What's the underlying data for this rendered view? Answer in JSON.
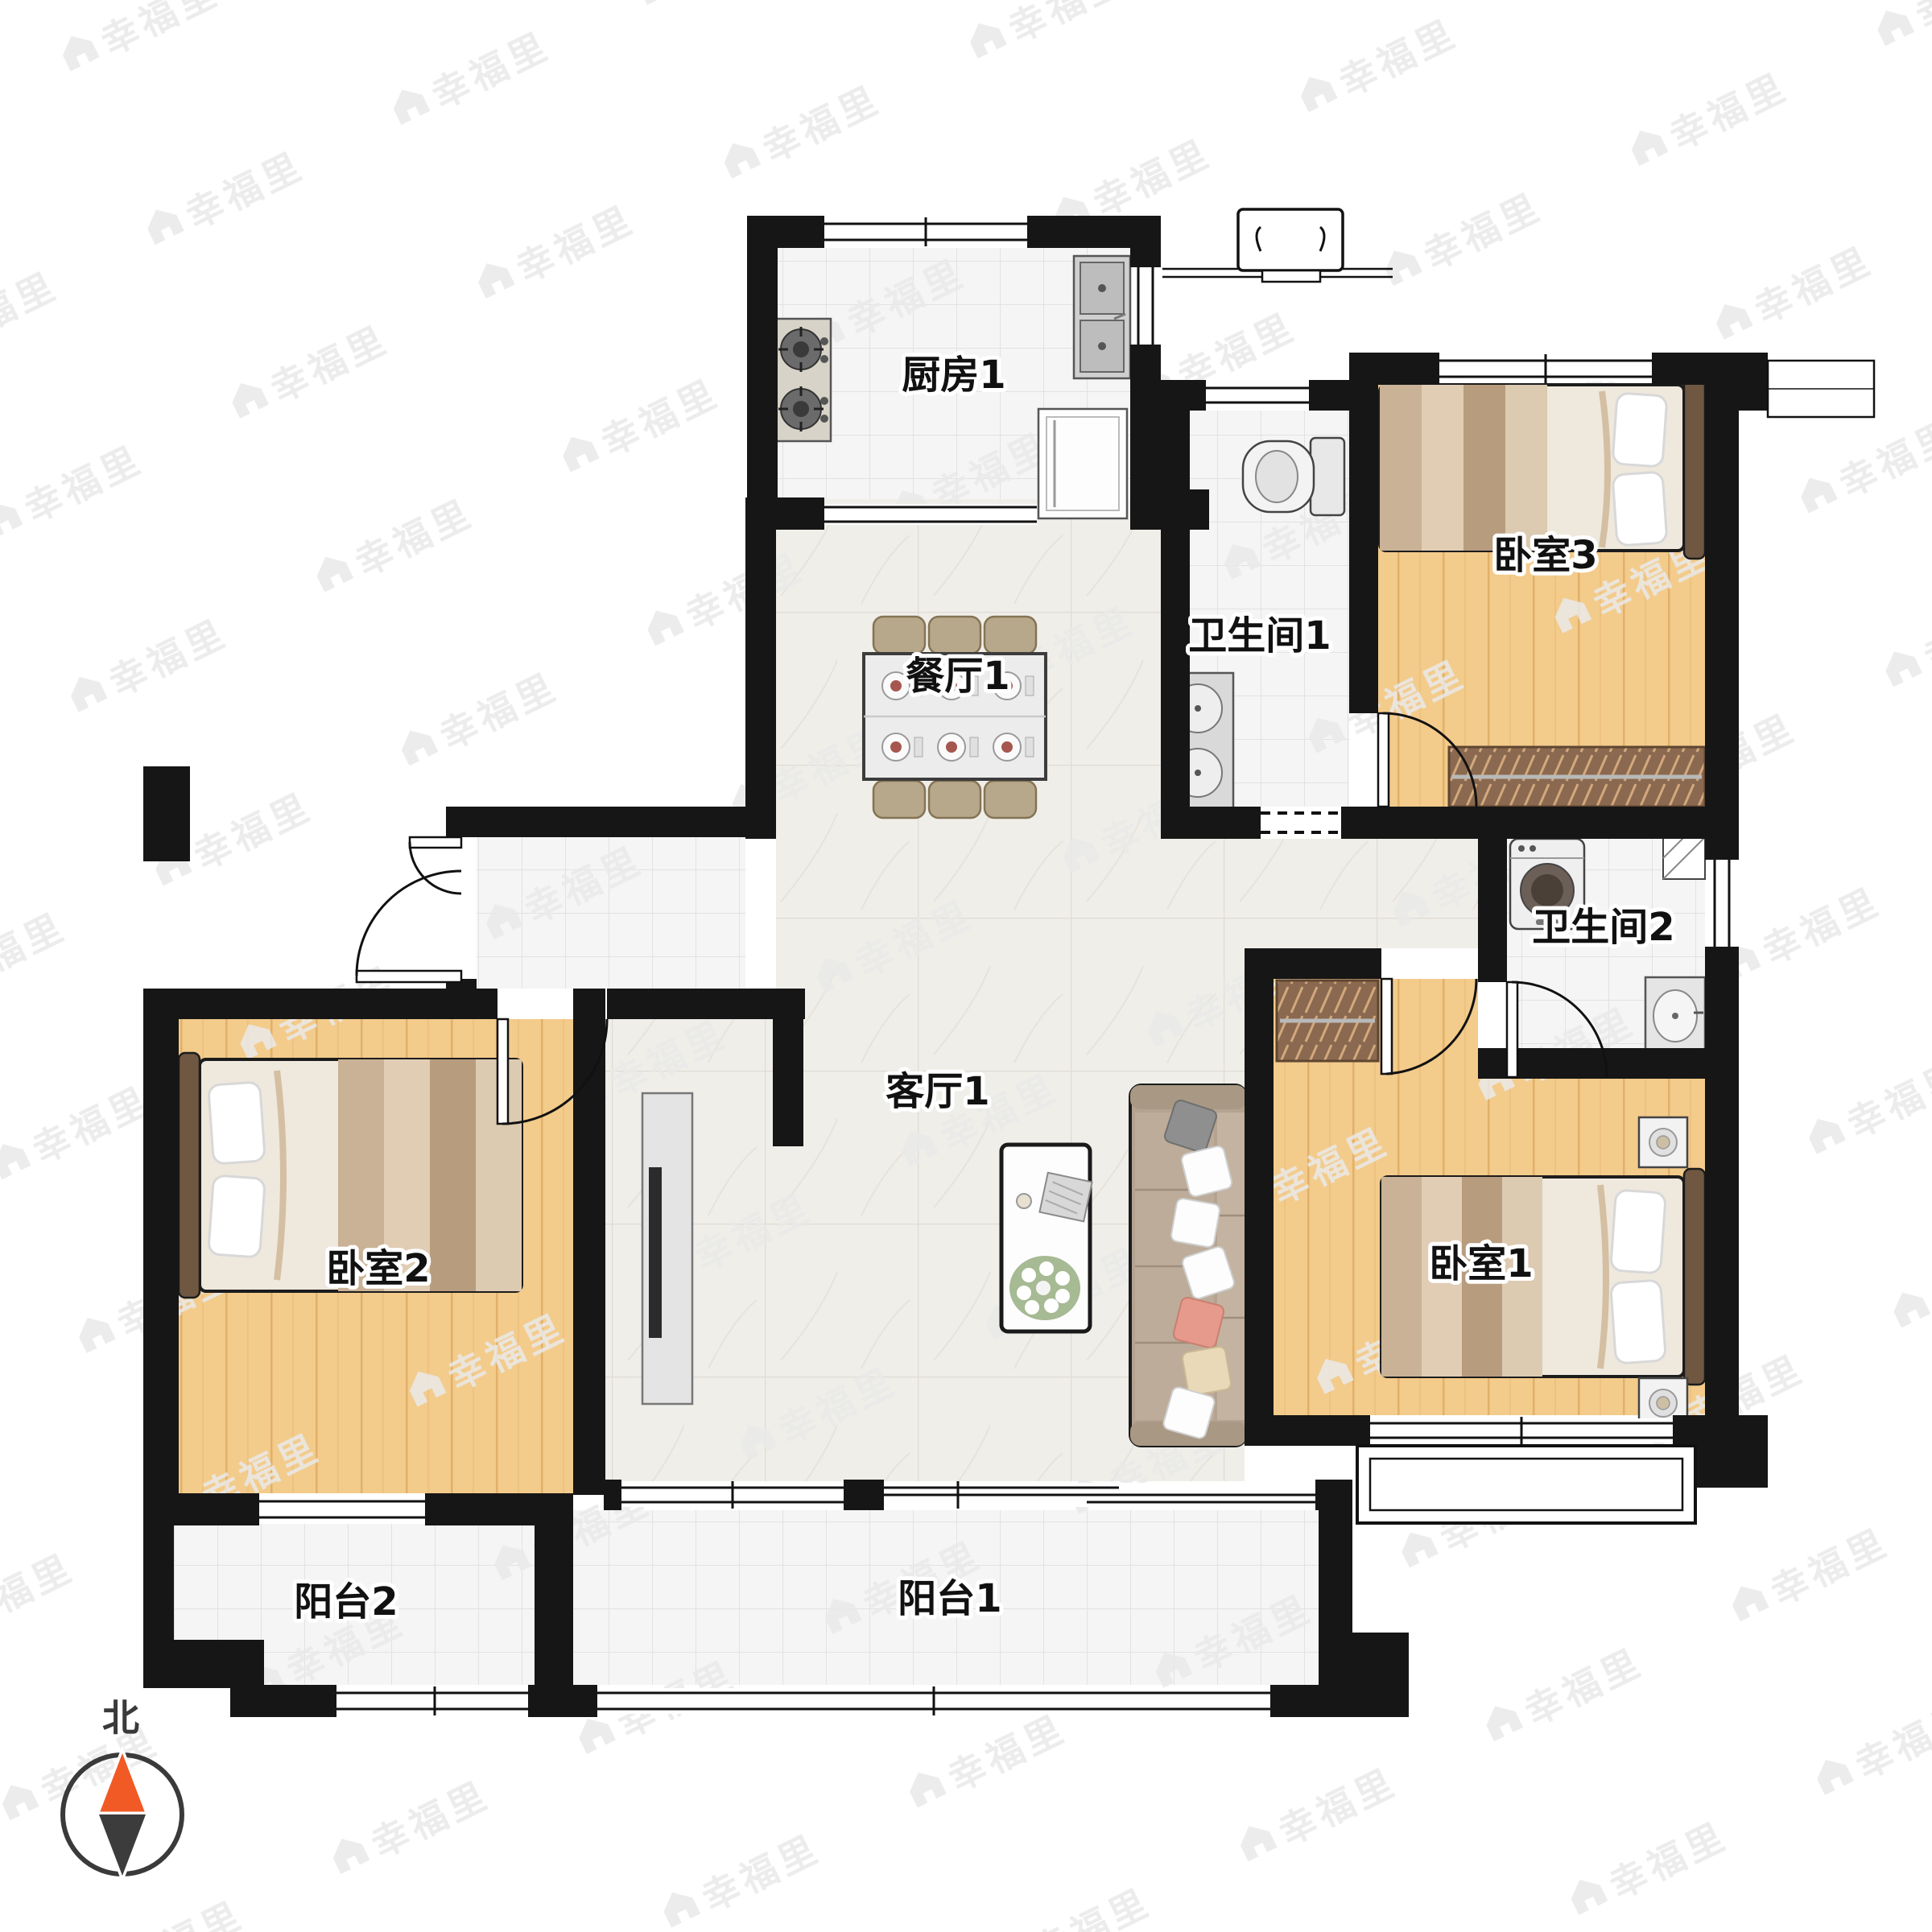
{
  "rooms": {
    "kitchen": {
      "label": "厨房1"
    },
    "bath1": {
      "label": "卫生间1"
    },
    "bedroom3": {
      "label": "卧室3"
    },
    "dining": {
      "label": "餐厅1"
    },
    "bath2": {
      "label": "卫生间2"
    },
    "living": {
      "label": "客厅1"
    },
    "bedroom2": {
      "label": "卧室2"
    },
    "bedroom1": {
      "label": "卧室1"
    },
    "balcony2": {
      "label": "阳台2"
    },
    "balcony1": {
      "label": "阳台1"
    }
  },
  "compass": {
    "north_label": "北"
  },
  "watermark": {
    "text": "幸福里"
  },
  "colors": {
    "wall": "#161616",
    "wood_floor": "#f3cb8b",
    "tile_floor": "#f5f5f5",
    "marble_floor": "#f0eee9",
    "compass_north": "#f15a24",
    "wardrobe": "#8a6950",
    "sofa": "#b3a390"
  }
}
